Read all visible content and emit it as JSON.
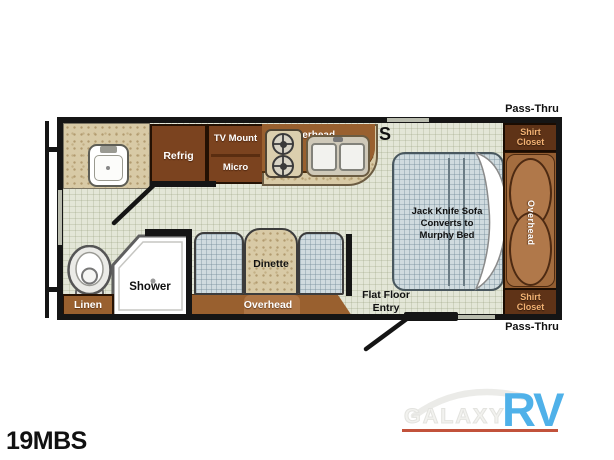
{
  "model": "19MBS",
  "plan": {
    "pass_thru_top": "Pass-Thru",
    "pass_thru_bottom": "Pass-Thru",
    "symbol": "S",
    "kitchen": {
      "refrig": "Refrig",
      "tv_mount": "TV Mount",
      "micro": "Micro",
      "overhead": "Overhead"
    },
    "dinette": {
      "table": "Dinette",
      "overhead": "Overhead"
    },
    "bath": {
      "shower": "Shower",
      "linen": "Linen"
    },
    "bedroom": {
      "sofa_line1": "Jack Knife Sofa",
      "sofa_line2": "Converts to",
      "sofa_line3": "Murphy Bed",
      "wardrobe_overhead": "Overhead",
      "shirt_top_line1": "Shirt",
      "shirt_top_line2": "Closet",
      "shirt_bottom_line1": "Shirt",
      "shirt_bottom_line2": "Closet"
    },
    "entry": {
      "line1": "Flat Floor",
      "line2": "Entry"
    }
  },
  "watermark": {
    "galaxy": "GALAXY",
    "rv": "RV"
  },
  "colors": {
    "logo_blue": "#4fb1e9",
    "logo_underline": "#c2523b",
    "cabinet_dark": "#7b431f",
    "cabinet_mid": "#99602f",
    "wardrobe_brown": "#a46d3f",
    "closet_text": "#f3b273",
    "wall_black": "#151515",
    "floor_green": "#e3e6d7",
    "fabric_blue": "#d0dbdf",
    "counter_tan": "#d8caa6"
  }
}
